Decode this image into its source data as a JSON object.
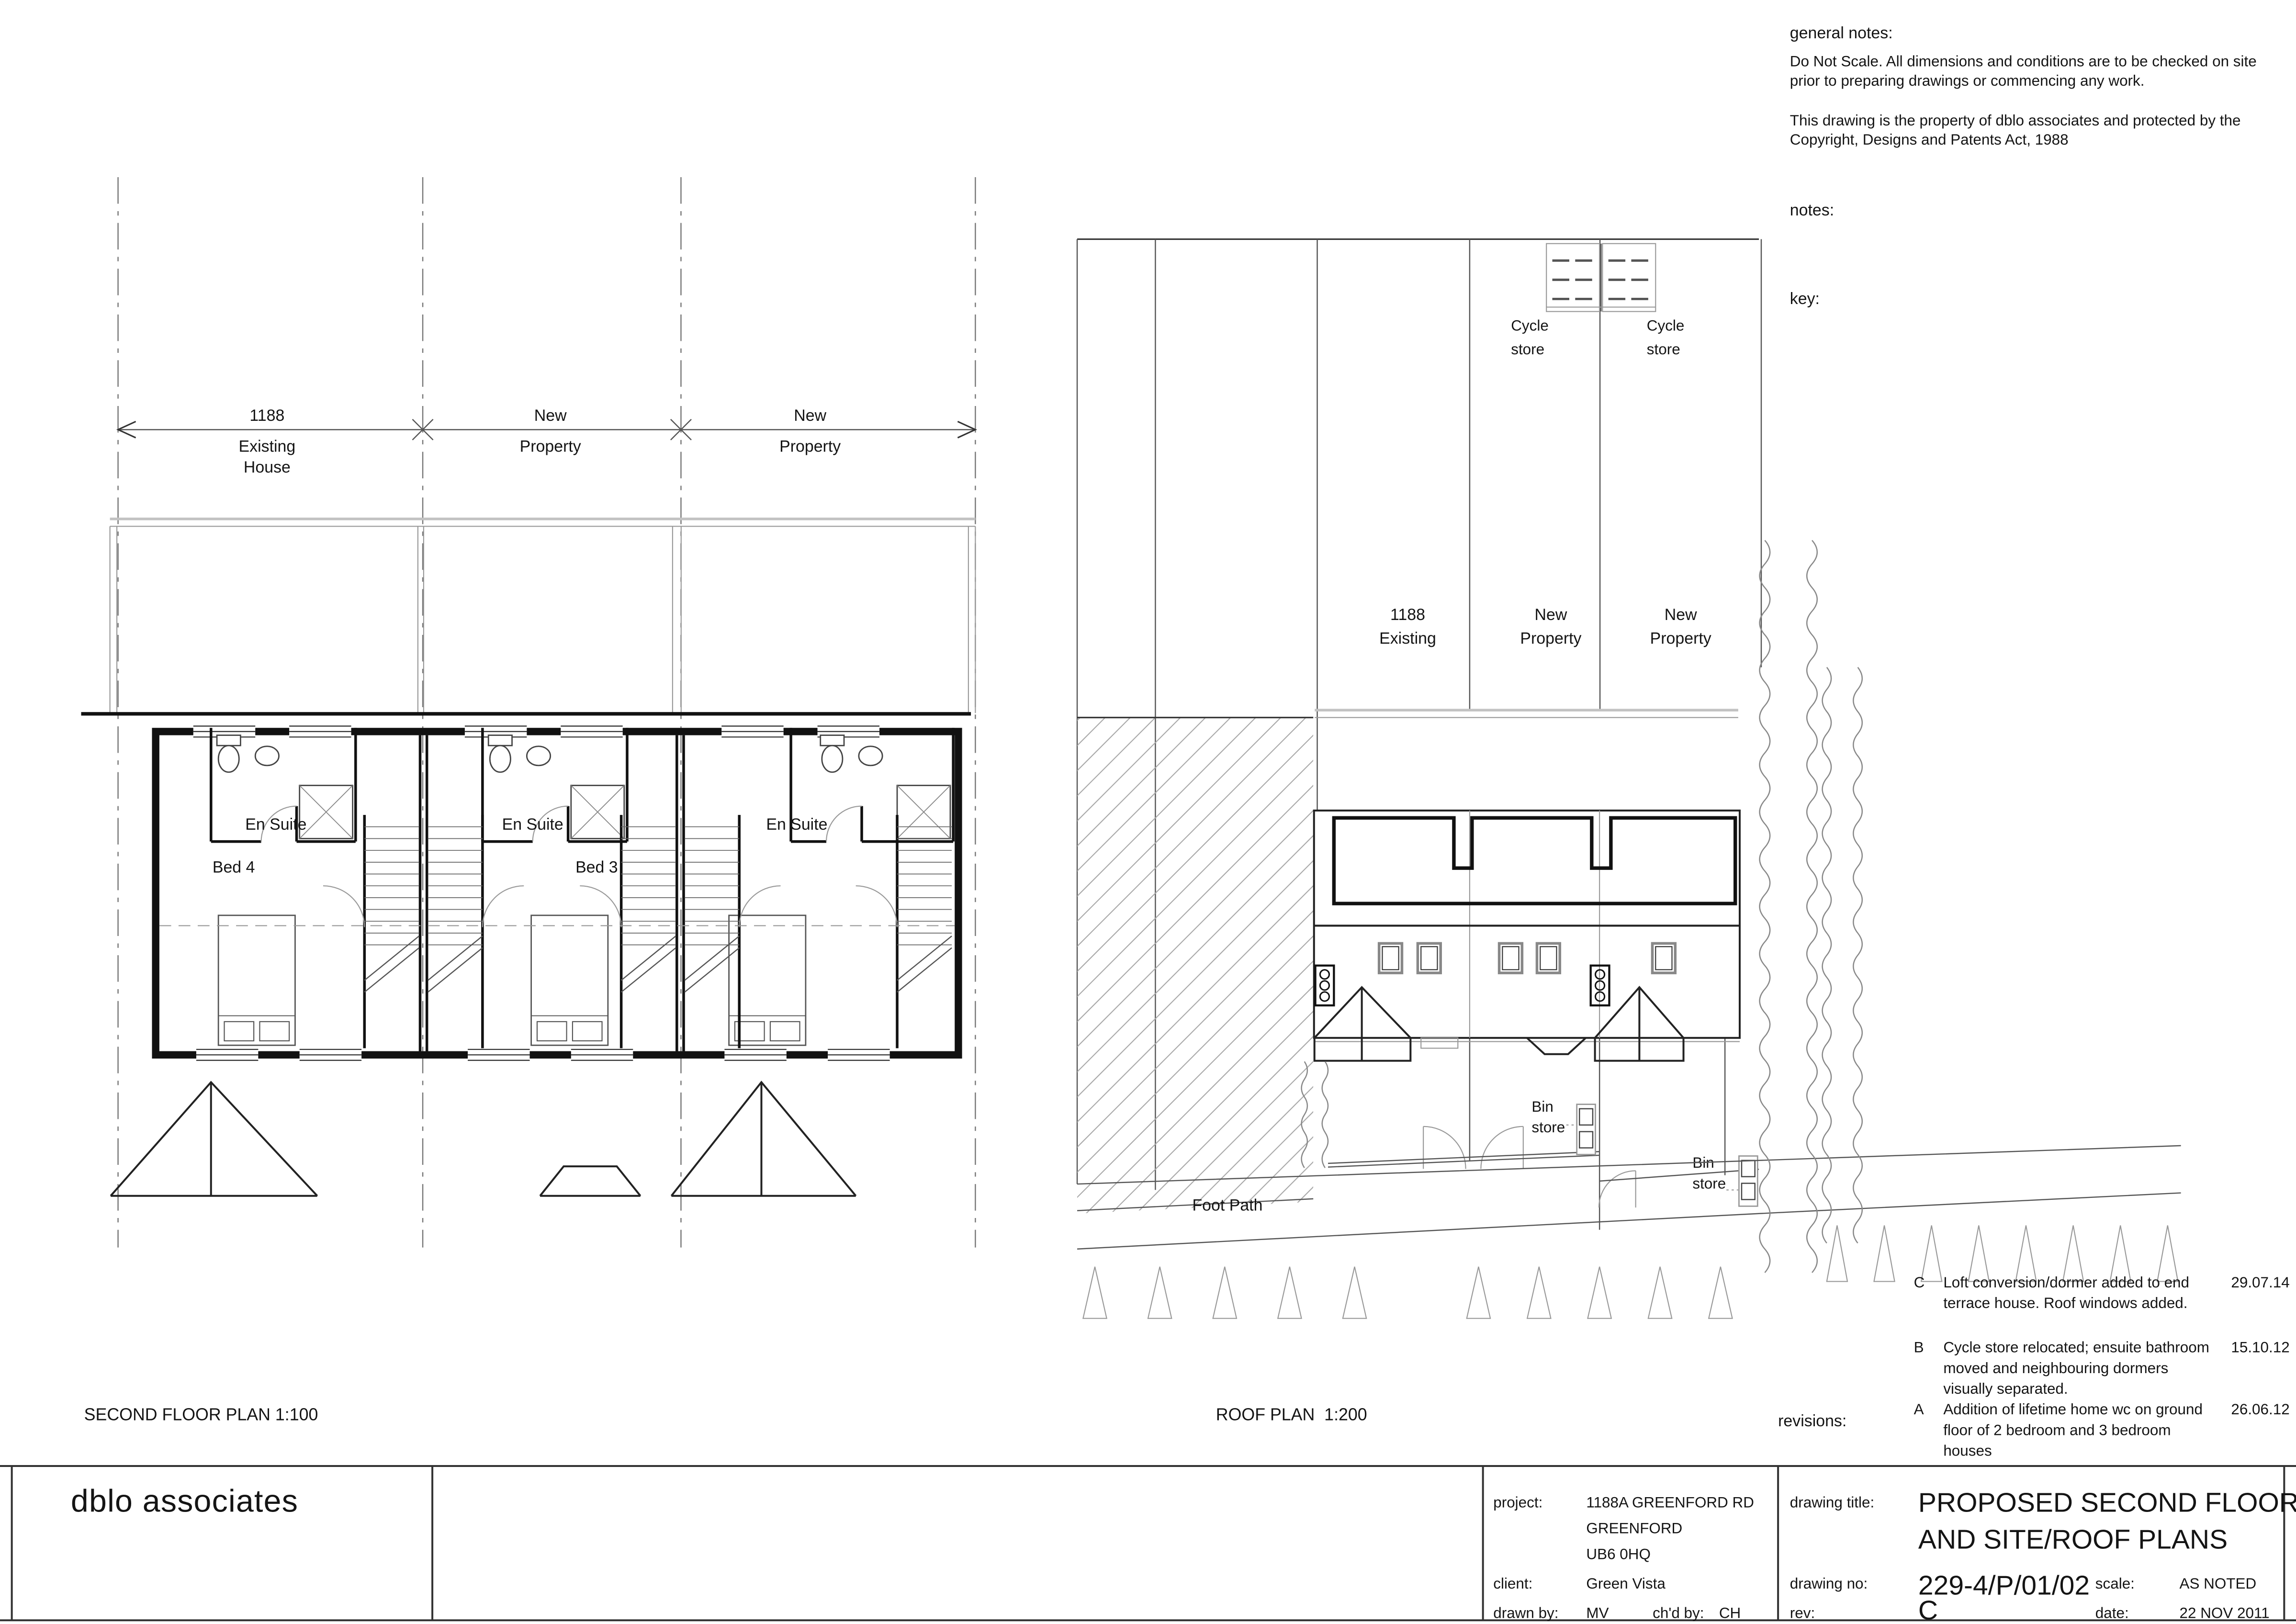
{
  "notes": {
    "general_heading": "general notes:",
    "line1": "Do Not Scale. All dimensions and conditions are to be checked on site",
    "line2": "prior to preparing drawings or commencing any work.",
    "line3": "This drawing is the property of dblo associates and protected by the",
    "line4": "Copyright, Designs and Patents Act, 1988",
    "notes_heading": "notes:",
    "key_heading": "key:"
  },
  "floor_plan": {
    "title": "SECOND FLOOR PLAN 1:100",
    "dims": [
      {
        "line1": "1188",
        "line2": "Existing",
        "line3": "House"
      },
      {
        "line1": "New",
        "line2": "Property"
      },
      {
        "line1": "New",
        "line2": "Property"
      }
    ],
    "labels": {
      "ensuite1": "En Suite",
      "ensuite2": "En Suite",
      "ensuite3": "En Suite",
      "bed4": "Bed 4",
      "bed3": "Bed 3"
    }
  },
  "roof_plan": {
    "title": "ROOF PLAN  1:200",
    "cycle1_line1": "Cycle",
    "cycle1_line2": "store",
    "cycle2_line1": "Cycle",
    "cycle2_line2": "store",
    "props": [
      {
        "line1": "1188",
        "line2": "Existing"
      },
      {
        "line1": "New",
        "line2": "Property"
      },
      {
        "line1": "New",
        "line2": "Property"
      }
    ],
    "bin1_line1": "Bin",
    "bin1_line2": "store",
    "bin2_line1": "Bin",
    "bin2_line2": "store",
    "footpath": "Foot Path"
  },
  "revisions": {
    "heading": "revisions:",
    "items": [
      {
        "rev": "C",
        "date": "29.07.14",
        "line1": "Loft conversion/dormer added to end",
        "line2": "terrace house. Roof windows added.",
        "line3": ""
      },
      {
        "rev": "B",
        "date": "15.10.12",
        "line1": "Cycle store relocated; ensuite bathroom",
        "line2": "moved and neighbouring dormers",
        "line3": "visually separated."
      },
      {
        "rev": "A",
        "date": "26.06.12",
        "line1": "Addition of lifetime home wc on ground",
        "line2": "floor of 2 bedroom and 3 bedroom",
        "line3": "houses"
      }
    ]
  },
  "title_block": {
    "company": "dblo associates",
    "project_label": "project:",
    "project_line1": "1188A GREENFORD RD",
    "project_line2": "GREENFORD",
    "project_line3": "UB6 0HQ",
    "client_label": "client:",
    "client": "Green Vista",
    "drawn_by_label": "drawn by:",
    "drawn_by": "MV",
    "checked_by_label": "ch'd by:",
    "checked_by": "CH",
    "drawing_title_label": "drawing title:",
    "drawing_title_line1": "PROPOSED SECOND FLOOR",
    "drawing_title_line2": "AND SITE/ROOF PLANS",
    "drawing_no_label": "drawing no:",
    "drawing_no": "229-4/P/01/02",
    "rev_label": "rev:",
    "rev": "C",
    "scale_label": "scale:",
    "scale": "AS NOTED",
    "date_label": "date:",
    "date": "22 NOV 2011"
  }
}
